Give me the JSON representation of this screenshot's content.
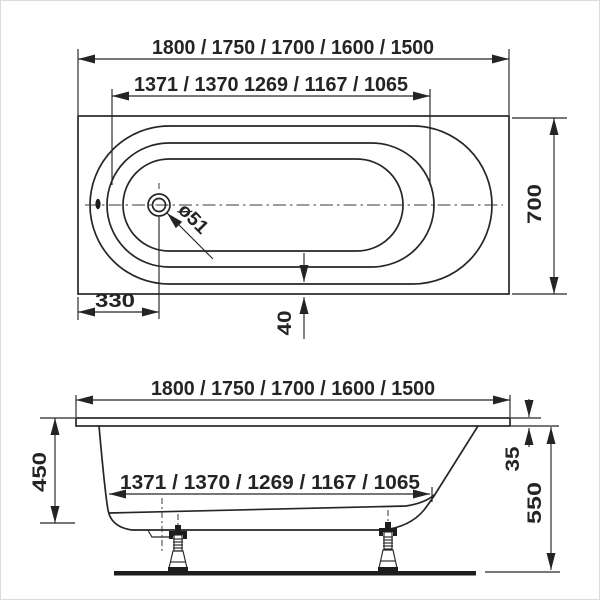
{
  "drawing": {
    "units": "mm",
    "line_color": "#262626",
    "background": "#ffffff",
    "top_view": {
      "overall_length": "1800 / 1750 / 1700 / 1600 / 1500",
      "bottom_length": "1371 / 1370 1269 / 1167 / 1065",
      "overall_width": "700",
      "drain_offset": "330",
      "drain_diameter": "ø51",
      "bottom_edge_offset": "40"
    },
    "side_view": {
      "overall_length": "1800 / 1750 / 1700 / 1600 / 1500",
      "bottom_length": "1371 / 1370 / 1269 / 1167 / 1065",
      "tub_depth": "450",
      "rim_thickness": "35",
      "underside_height": "550"
    }
  }
}
